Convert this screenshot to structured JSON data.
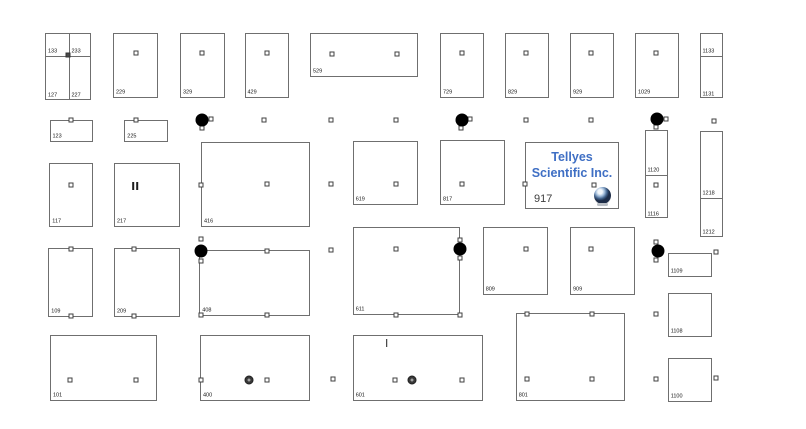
{
  "canvas": {
    "width": 806,
    "height": 429,
    "background": "#ffffff",
    "line_color": "#6f6f6f",
    "label_color": "#141414"
  },
  "booth_917": {
    "exhibitor_line1": "Tellyes",
    "exhibitor_line2": "Scientific Inc.",
    "number": "917",
    "text_color": "#3f6fc4",
    "logo": "globe-sphere-logo"
  },
  "booths": [
    {
      "x": 45,
      "y": 33,
      "w": 46,
      "h": 67,
      "vdiv": 23,
      "hdiv": 22,
      "center_square": true,
      "labels": [
        {
          "text": "133",
          "x": 2,
          "y": 21
        },
        {
          "text": "233",
          "x": 25.5,
          "y": 21
        },
        {
          "text": "127",
          "x": 2,
          "y": 65
        },
        {
          "text": "227",
          "x": 25.5,
          "y": 65
        }
      ]
    },
    {
      "number": "229",
      "x": 113,
      "y": 33,
      "w": 44.5,
      "h": 65
    },
    {
      "number": "329",
      "x": 180,
      "y": 33,
      "w": 45,
      "h": 65
    },
    {
      "number": "429",
      "x": 244.5,
      "y": 33,
      "w": 44,
      "h": 65
    },
    {
      "number": "529",
      "x": 310,
      "y": 33,
      "w": 108,
      "h": 44
    },
    {
      "number": "729",
      "x": 440,
      "y": 33,
      "w": 43.5,
      "h": 65
    },
    {
      "number": "829",
      "x": 505,
      "y": 33,
      "w": 43.5,
      "h": 65
    },
    {
      "number": "929",
      "x": 570,
      "y": 33,
      "w": 43.5,
      "h": 65
    },
    {
      "number": "1029",
      "x": 635,
      "y": 33,
      "w": 43.5,
      "h": 65
    },
    {
      "x": 700,
      "y": 33,
      "w": 22.5,
      "h": 65,
      "hdiv": 21.5,
      "labels": [
        {
          "text": "1133",
          "x": 1.5,
          "y": 20.5
        },
        {
          "text": "1131",
          "x": 1.5,
          "y": 63.5
        }
      ]
    },
    {
      "number": "123",
      "x": 49.5,
      "y": 120,
      "w": 43,
      "h": 21.7
    },
    {
      "number": "225",
      "x": 124.3,
      "y": 120,
      "w": 44,
      "h": 21.7
    },
    {
      "number": "117",
      "x": 49.3,
      "y": 163.3,
      "w": 43.4,
      "h": 64
    },
    {
      "number": "217",
      "x": 114,
      "y": 163.3,
      "w": 66,
      "h": 64
    },
    {
      "number": "416",
      "x": 201,
      "y": 141.7,
      "w": 109,
      "h": 85
    },
    {
      "number": "619",
      "x": 352.7,
      "y": 141,
      "w": 65.6,
      "h": 64
    },
    {
      "number": "817",
      "x": 440,
      "y": 140,
      "w": 65,
      "h": 65
    },
    {
      "special": "tellyes",
      "x": 525,
      "y": 141.5,
      "w": 94,
      "h": 67
    },
    {
      "x": 645,
      "y": 130,
      "w": 23,
      "h": 88,
      "hdiv": 44,
      "labels": [
        {
          "text": "1120",
          "x": 1.5,
          "y": 43
        },
        {
          "text": "1116",
          "x": 1.5,
          "y": 86.5
        }
      ]
    },
    {
      "x": 700,
      "y": 131,
      "w": 22.7,
      "h": 105.7,
      "hdiv": 65.7,
      "labels": [
        {
          "text": "1218",
          "x": 1.5,
          "y": 64.7
        },
        {
          "text": "1212",
          "x": 1.5,
          "y": 104
        }
      ]
    },
    {
      "number": "109",
      "x": 48.3,
      "y": 248.3,
      "w": 45,
      "h": 68.4
    },
    {
      "number": "209",
      "x": 114,
      "y": 248.3,
      "w": 66,
      "h": 68.4
    },
    {
      "number": "408",
      "x": 199.3,
      "y": 250,
      "w": 110.7,
      "h": 66
    },
    {
      "number": "611",
      "x": 352.7,
      "y": 226.7,
      "w": 107.6,
      "h": 88
    },
    {
      "number": "809",
      "x": 482.7,
      "y": 226.7,
      "w": 65.6,
      "h": 68.3
    },
    {
      "number": "909",
      "x": 570,
      "y": 226.7,
      "w": 65,
      "h": 68.3
    },
    {
      "number": "1109",
      "x": 667.7,
      "y": 253.3,
      "w": 44,
      "h": 23.4
    },
    {
      "number": "1108",
      "x": 667.7,
      "y": 292.7,
      "w": 44,
      "h": 44
    },
    {
      "number": "1100",
      "x": 667.7,
      "y": 358.3,
      "w": 44,
      "h": 43.4
    },
    {
      "number": "101",
      "x": 50,
      "y": 335,
      "w": 107.3,
      "h": 65.7
    },
    {
      "number": "400",
      "x": 200,
      "y": 335,
      "w": 110,
      "h": 65.7
    },
    {
      "number": "601",
      "x": 352.7,
      "y": 335,
      "w": 130,
      "h": 65.7
    },
    {
      "number": "801",
      "x": 515.7,
      "y": 313.3,
      "w": 109.3,
      "h": 87.4
    }
  ],
  "markers": {
    "squares": [
      [
        136,
        53
      ],
      [
        202,
        53
      ],
      [
        266.5,
        53
      ],
      [
        331.5,
        54
      ],
      [
        396.5,
        54
      ],
      [
        461.5,
        53
      ],
      [
        526,
        53
      ],
      [
        591,
        53
      ],
      [
        655.5,
        53
      ],
      [
        70.8,
        119.5
      ],
      [
        136,
        119.5
      ],
      [
        210.7,
        119.3
      ],
      [
        201.7,
        128.3
      ],
      [
        264,
        120
      ],
      [
        331,
        120
      ],
      [
        396,
        120
      ],
      [
        470,
        119
      ],
      [
        461,
        128.3
      ],
      [
        526,
        120
      ],
      [
        591,
        120
      ],
      [
        665.5,
        119.3
      ],
      [
        656,
        127
      ],
      [
        714,
        120.5
      ],
      [
        71,
        185
      ],
      [
        201,
        185
      ],
      [
        266.7,
        184
      ],
      [
        331,
        184.3
      ],
      [
        396,
        184.3
      ],
      [
        462,
        184.3
      ],
      [
        525,
        183.5
      ],
      [
        594,
        185
      ],
      [
        656,
        185
      ],
      [
        71,
        248.5
      ],
      [
        134.3,
        248.5
      ],
      [
        201,
        239.3
      ],
      [
        201,
        261
      ],
      [
        266.7,
        250.7
      ],
      [
        331,
        250
      ],
      [
        396,
        249
      ],
      [
        460,
        240
      ],
      [
        460,
        258.3
      ],
      [
        526,
        249
      ],
      [
        590.7,
        249
      ],
      [
        656,
        241.7
      ],
      [
        656,
        260
      ],
      [
        716,
        251.7
      ],
      [
        71,
        316
      ],
      [
        134.3,
        316
      ],
      [
        201,
        314.5
      ],
      [
        266.7,
        314.5
      ],
      [
        396,
        314.7
      ],
      [
        460,
        314.7
      ],
      [
        526.7,
        314.3
      ],
      [
        591.7,
        314.3
      ],
      [
        656,
        314
      ],
      [
        70,
        380
      ],
      [
        135.7,
        380
      ],
      [
        201,
        380
      ],
      [
        266.7,
        380
      ],
      [
        332.7,
        379.3
      ],
      [
        395.3,
        380
      ],
      [
        461.7,
        380
      ],
      [
        526.7,
        379.3
      ],
      [
        591.7,
        379.3
      ],
      [
        656,
        379.3
      ],
      [
        716,
        378.3
      ]
    ],
    "filled_squares": [
      [
        68,
        54.5
      ]
    ],
    "columns": [
      [
        202,
        120
      ],
      [
        461.5,
        119.5
      ],
      [
        656.5,
        119
      ],
      [
        201,
        250.5
      ],
      [
        460,
        249
      ],
      [
        657.5,
        250.5
      ]
    ],
    "ports": [
      [
        249.3,
        380
      ],
      [
        412.3,
        380
      ]
    ],
    "bars": [
      {
        "x": 135,
        "y": 186,
        "count": 2
      },
      {
        "x": 386.7,
        "y": 343,
        "count": 1
      }
    ]
  }
}
